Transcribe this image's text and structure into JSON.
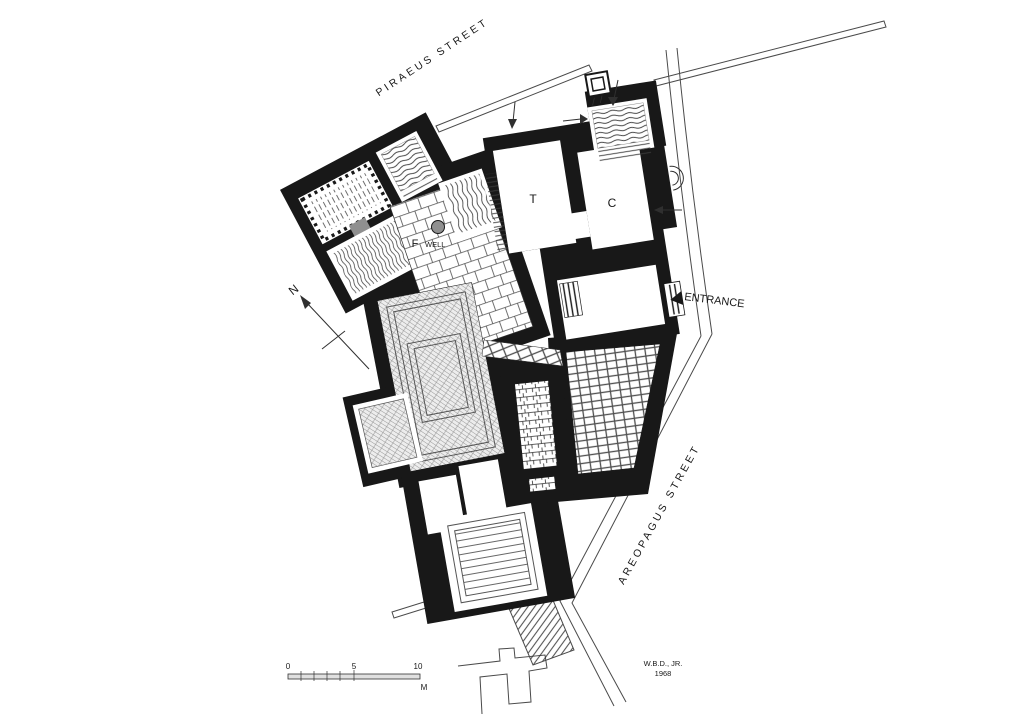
{
  "colors": {
    "background": "#ffffff",
    "ink": "#181818",
    "thin_line": "#4a4a4a",
    "well_fill": "#8f8f8f",
    "pattern_line": "#4f4f4f"
  },
  "streets": {
    "piraeus": "PIRAEUS STREET",
    "areopagus": "AREOPAGUS STREET"
  },
  "labels": {
    "entrance": "ENTRANCE",
    "room_t": "T",
    "room_c": "C",
    "fountain": "F",
    "well": "WELL",
    "question": "?",
    "north": "N"
  },
  "scale_bar": {
    "zero": "0",
    "five": "5",
    "ten": "10",
    "unit": "M"
  },
  "credit": {
    "author": "W.B.D., JR.",
    "year": "1968"
  },
  "icons": {
    "north_arrow": "north-arrow",
    "well_marker": "well-circle",
    "entrance_door_arrow": "door-arrow",
    "scale_bar": "scale-bar"
  }
}
